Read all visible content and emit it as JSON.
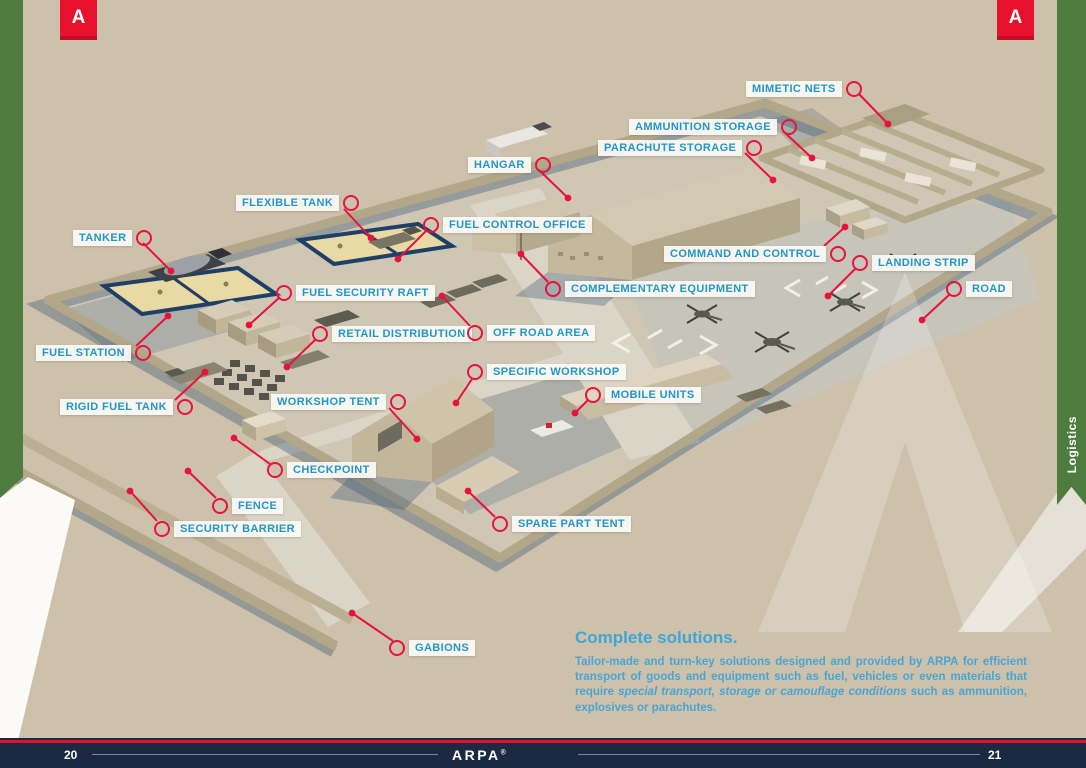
{
  "page": {
    "left_page_number": "20",
    "right_page_number": "21",
    "footer_brand": "ARPA",
    "footer_brand_mark": "®",
    "corner_flag_letter": "A",
    "side_tab_label": "Logistics"
  },
  "colors": {
    "background_tan": "#cdc1ac",
    "accent_red": "#e8112d",
    "callout_blue": "#2196c9",
    "footer_navy": "#1b2942",
    "ribbon_green": "#4e7b3e"
  },
  "callouts": [
    {
      "text": "MIMETIC NETS"
    },
    {
      "text": "AMMUNITION STORAGE"
    },
    {
      "text": "PARACHUTE STORAGE"
    },
    {
      "text": "HANGAR"
    },
    {
      "text": "FLEXIBLE TANK"
    },
    {
      "text": "FUEL CONTROL OFFICE"
    },
    {
      "text": "TANKER"
    },
    {
      "text": "FUEL SECURITY RAFT"
    },
    {
      "text": "COMPLEMENTARY EQUIPMENT"
    },
    {
      "text": "COMMAND AND CONTROL"
    },
    {
      "text": "LANDING STRIP"
    },
    {
      "text": "ROAD"
    },
    {
      "text": "RETAIL DISTRIBUTION"
    },
    {
      "text": "OFF ROAD AREA"
    },
    {
      "text": "FUEL STATION"
    },
    {
      "text": "SPECIFIC WORKSHOP"
    },
    {
      "text": "RIGID FUEL TANK"
    },
    {
      "text": "WORKSHOP TENT"
    },
    {
      "text": "MOBILE UNITS"
    },
    {
      "text": "CHECKPOINT"
    },
    {
      "text": "FENCE"
    },
    {
      "text": "SECURITY BARRIER"
    },
    {
      "text": "SPARE PART TENT"
    },
    {
      "text": "GABIONS"
    }
  ],
  "solutions": {
    "heading": "Complete solutions.",
    "body_start": "Tailor-made and turn-key solutions designed and provided by ARPA for efficient transport of goods and equipment such as fuel, vehicles or even materials that require ",
    "body_emphasis": "special transport, storage or camouflage conditions",
    "body_end": " such as ammunition, explosives or parachutes."
  }
}
